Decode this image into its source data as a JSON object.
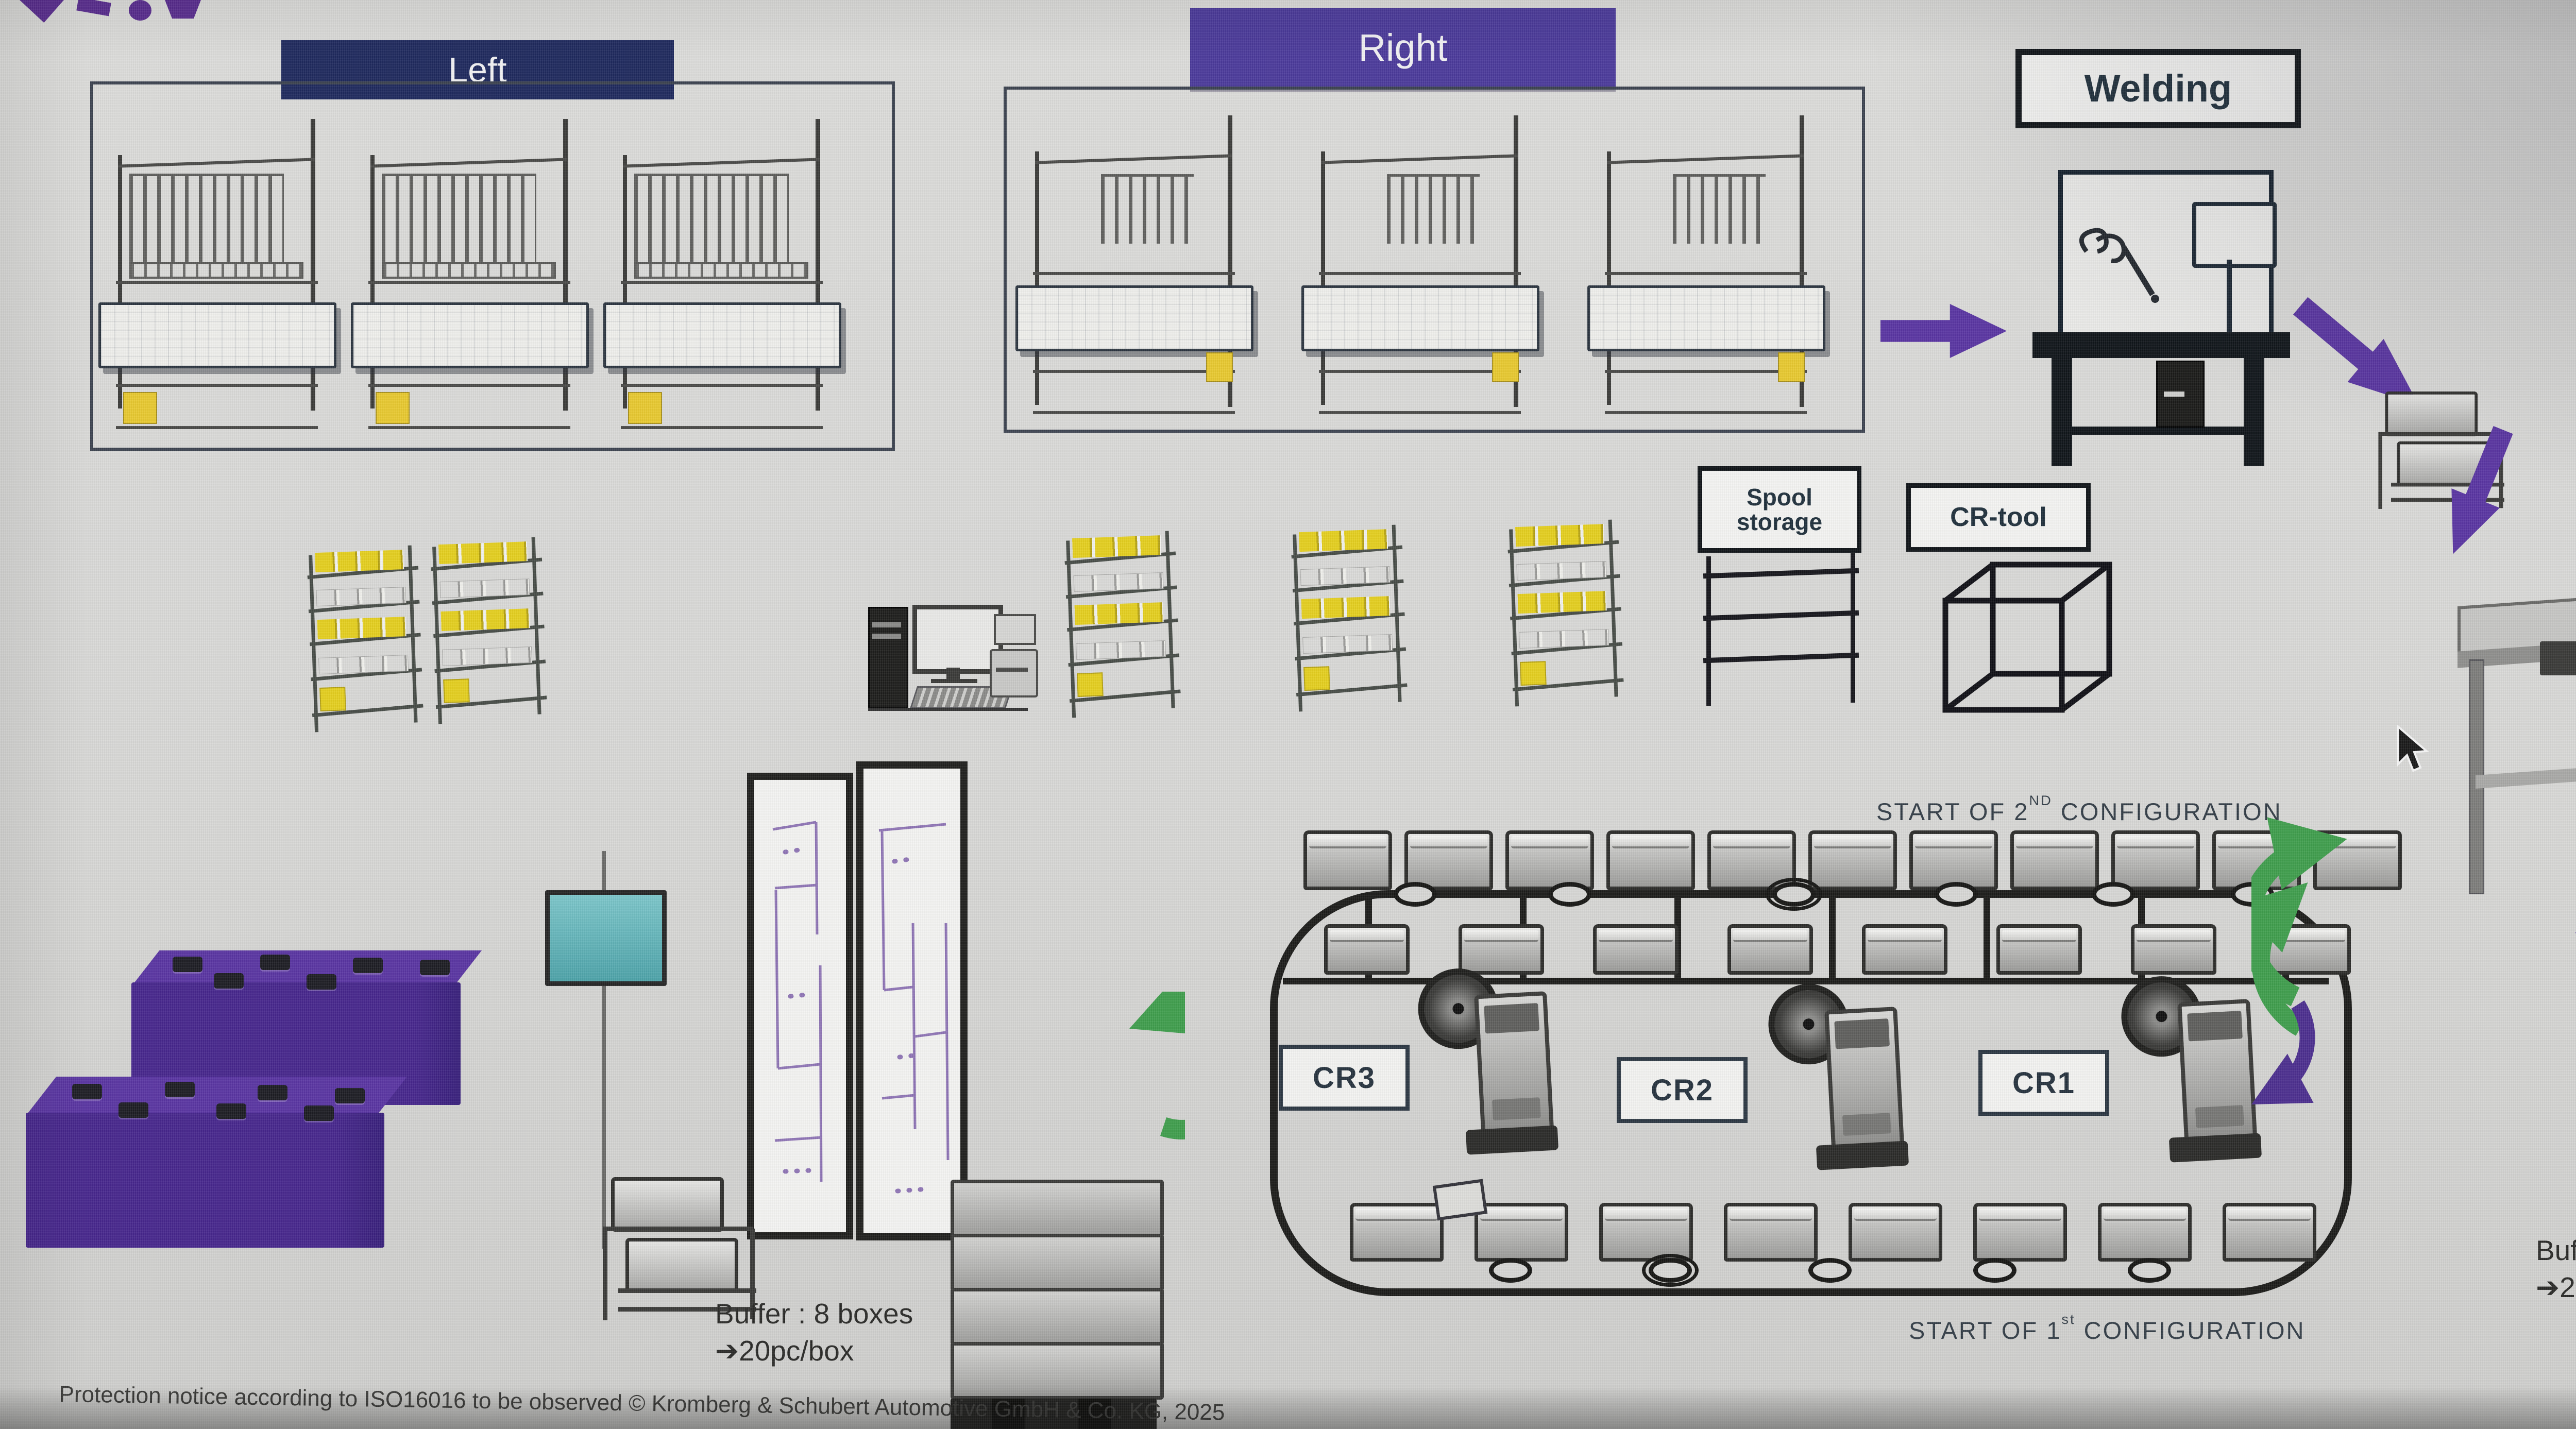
{
  "colors": {
    "header_navy": "#1f2a5e",
    "header_purple": "#4b3a9b",
    "arrow_purple": "#5a35a2",
    "arrow_green": "#3f9e4d",
    "kanban_yellow": "#e4cf1f",
    "monitor_teal": "#5ab4ba"
  },
  "headers": {
    "left": "Left",
    "right": "Right"
  },
  "labels": {
    "welding": "Welding",
    "spool_line1": "Spool",
    "spool_line2": "storage",
    "cr_tool": "CR-tool",
    "chp": "CHP",
    "cr3": "CR3",
    "cr2": "CR2",
    "cr1": "CR1"
  },
  "flow_text": {
    "start_2nd": {
      "prefix": "START OF 2",
      "sup": "ND",
      "suffix": " CONFIGURATION"
    },
    "start_1st": {
      "prefix": "START OF 1",
      "sup": "st",
      "suffix": " CONFIGURATION"
    }
  },
  "buffers": {
    "left": {
      "line1": "Buffer : 8 boxes",
      "arrow": "➔",
      "qty": "20pc/box"
    },
    "right": {
      "line1": "Buffer : 8 boxes",
      "arrow": "➔",
      "qty": "20pc/box"
    }
  },
  "chp_machine": {
    "side_label": "Drag Chain"
  },
  "footer": {
    "notice": "Protection notice according to ISO16016 to be observed © Kromberg & Schubert Automotive GmbH & Co. KG, 2025"
  }
}
